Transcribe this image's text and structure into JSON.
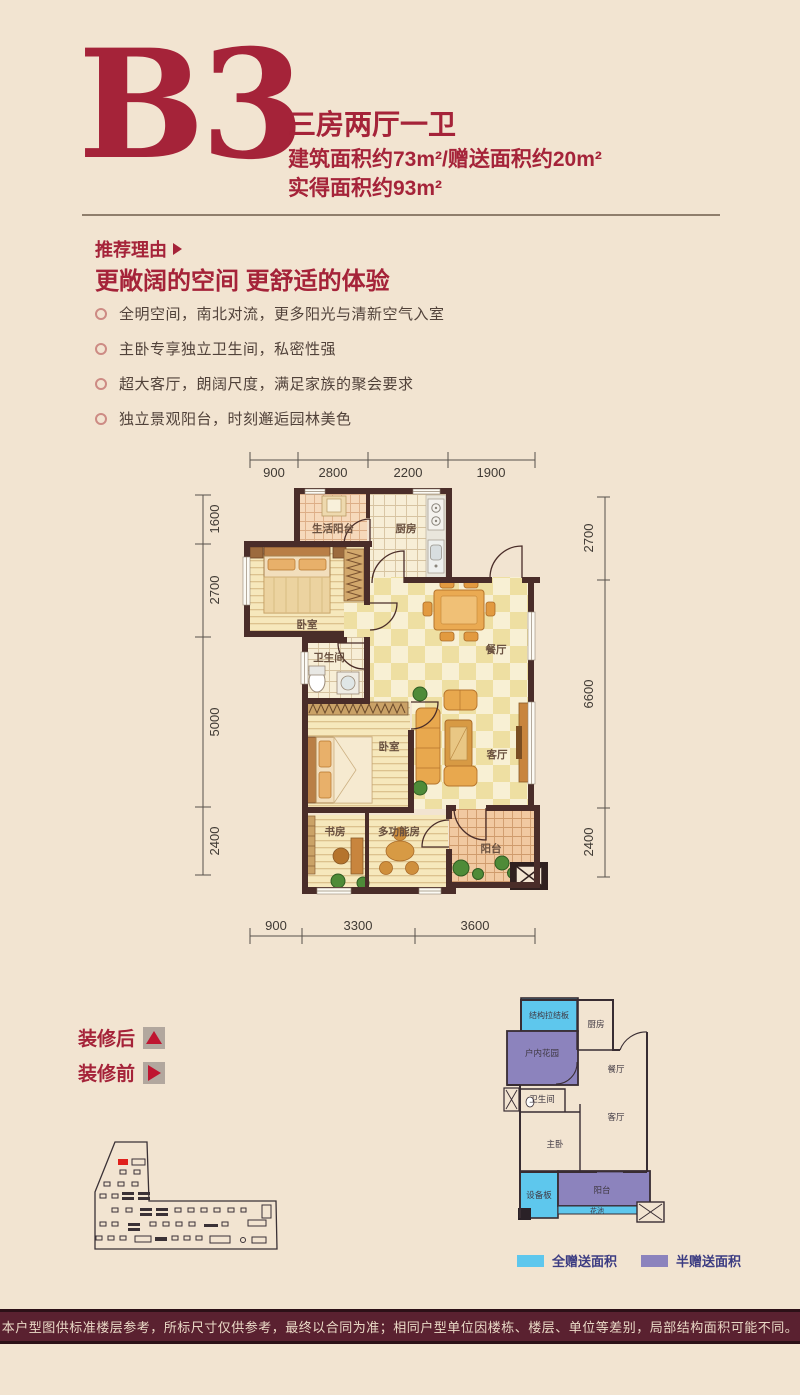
{
  "header": {
    "code": "B3",
    "layout": "三房两厅一卫",
    "area_line": "建筑面积约73m²/赠送面积约20m²",
    "net_line": "实得面积约93m²"
  },
  "recommend": {
    "lead": "推荐理由",
    "title": "更敞阔的空间 更舒适的体验",
    "bullets": [
      "全明空间，南北对流，更多阳光与清新空气入室",
      "主卧专享独立卫生间，私密性强",
      "超大客厅，朗阔尺度，满足家族的聚会要求",
      "独立景观阳台，时刻邂逅园林美色"
    ]
  },
  "floorplan": {
    "dims": {
      "top": [
        "900",
        "2800",
        "2200",
        "1900"
      ],
      "left": [
        "1600",
        "2700",
        "5000",
        "2400"
      ],
      "right": [
        "2700",
        "6600",
        "2400"
      ],
      "bottom": [
        "900",
        "3300",
        "3600"
      ]
    },
    "rooms": {
      "service_balcony": "生活阳台",
      "kitchen": "厨房",
      "bedroom1": "卧室",
      "bathroom": "卫生间",
      "dining": "餐厅",
      "bedroom2": "卧室",
      "living": "客厅",
      "study": "书房",
      "multi_room": "多功能房",
      "balcony": "阳台"
    }
  },
  "decoration": {
    "after": "装修后",
    "before": "装修前"
  },
  "mini_plan": {
    "rooms": {
      "tie_panel": "结构拉结板",
      "kitchen": "厨房",
      "indoor_garden": "户内花园",
      "dining": "餐厅",
      "bathroom": "卫生间",
      "living": "客厅",
      "master": "主卧",
      "equip_panel": "设备板",
      "balcony": "阳台",
      "flower_bed": "花池"
    },
    "legend": {
      "full": "全赠送面积",
      "half": "半赠送面积"
    }
  },
  "disclaimer": "本户型图供标准楼层参考，所标尺寸仅供参考，最终以合同为准；相同户型单位因楼栋、楼层、单位等差别，局部结构面积可能不同。",
  "colors": {
    "background": "#f2e4d1",
    "accent_red": "#a52339",
    "wall_brown": "#4a2d29",
    "gift_full_cyan": "#5ec7ed",
    "gift_half_purple": "#8c83bd",
    "legend_text": "#3c3c82",
    "site_highlight_red": "#e0201c",
    "disclaimer_bg": "#5a2130"
  }
}
